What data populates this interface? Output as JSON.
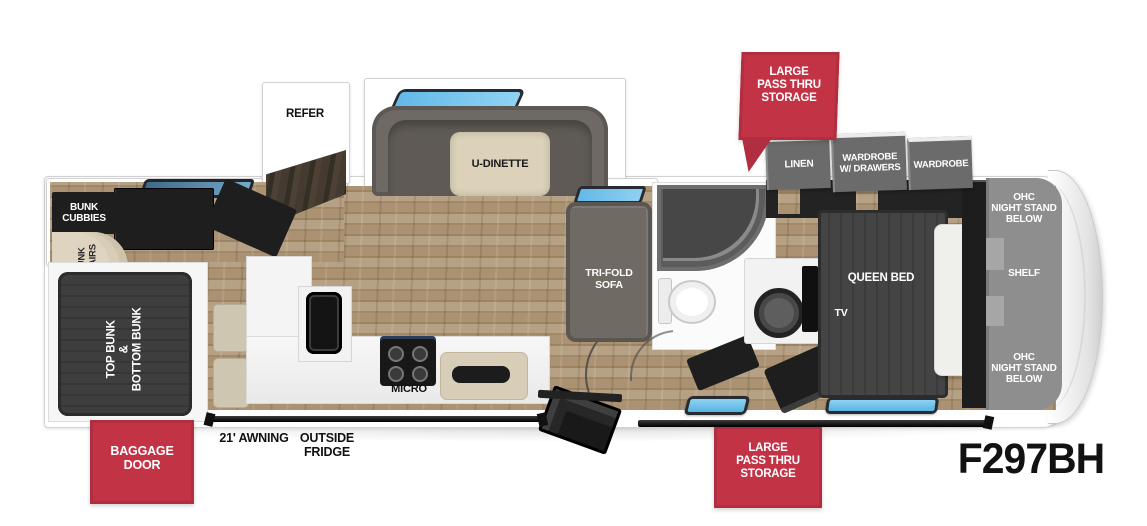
{
  "model_label": "F297BH",
  "callouts": {
    "storage_top": "LARGE\nPASS THRU\nSTORAGE",
    "storage_bottom": "LARGE\nPASS THRU\nSTORAGE",
    "baggage_door": "BAGGAGE\nDOOR"
  },
  "exterior": {
    "awning": "21' AWNING",
    "outside_fridge": "OUTSIDE\nFRIDGE"
  },
  "rooms": {
    "refer": "REFER",
    "u_dinette": "U-DINETTE",
    "bunk_cubbies": "BUNK\nCUBBIES",
    "bunk_stairs": "BUNK\nSTAIRS",
    "bunks": "TOP BUNK\n&\nBOTTOM BUNK",
    "micro": "MICRO",
    "tri_fold_sofa": "TRI-FOLD\nSOFA",
    "linen": "LINEN",
    "wardrobe_drawers": "WARDROBE\nW/ DRAWERS",
    "wardrobe": "WARDROBE",
    "ohc_top": "OHC\nNIGHT STAND\nBELOW",
    "shelf": "SHELF",
    "ohc_bottom": "OHC\nNIGHT STAND\nBELOW",
    "queen_bed": "QUEEN BED",
    "tv": "TV"
  },
  "colors": {
    "accent_red": "#c23345",
    "window_blue": "#6ec1ec",
    "floor_wood": "#a8916f",
    "furniture_dark": "#1f1f1f",
    "furniture_gray": "#6f6a64",
    "panel_gray": "#8d8d8d"
  }
}
